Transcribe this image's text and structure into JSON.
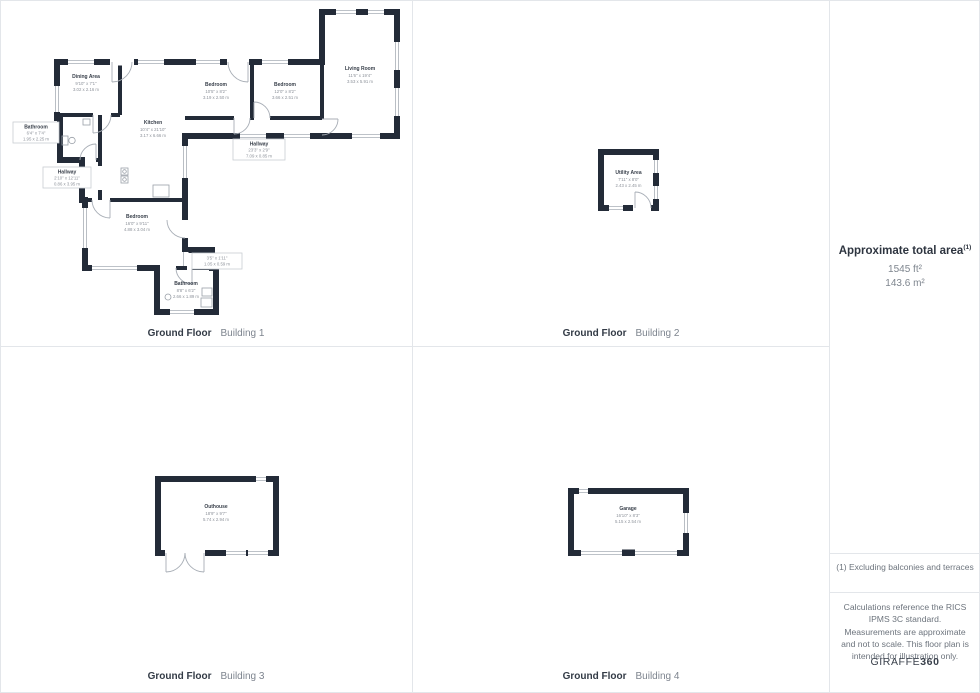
{
  "panels": [
    {
      "caption_bold": "Ground Floor",
      "caption_light": "Building 1",
      "rooms": {
        "dining": {
          "name": "Dining Area",
          "imperial": "9'10\" x 7'1\"",
          "metric": "3.02 x 2.16 m"
        },
        "kitchen": {
          "name": "Kitchen",
          "imperial": "10'4\" x 21'10\"",
          "metric": "3.17 x 6.66 m"
        },
        "bedroom1": {
          "name": "Bedroom",
          "imperial": "10'5\" x 8'2\"",
          "metric": "3.19 x 2.50 m"
        },
        "bedroom2": {
          "name": "Bedroom",
          "imperial": "12'0\" x 8'2\"",
          "metric": "3.66 x 2.51 m"
        },
        "living": {
          "name": "Living Room",
          "imperial": "11'6\" x 19'4\"",
          "metric": "3.53 x 5.91 m"
        },
        "hallway_top": {
          "name": "Hallway",
          "imperial": "23'3\" x 2'9\"",
          "metric": "7.09 x 0.85 m"
        },
        "bathroom_left": {
          "name": "Bathroom",
          "imperial": "6'4\" x 7'4\"",
          "metric": "1.95 x 2.25 m"
        },
        "hallway_left": {
          "name": "Hallway",
          "imperial": "2'10\" x 12'11\"",
          "metric": "0.86 x 3.95 m"
        },
        "bedroom3": {
          "name": "Bedroom",
          "imperial": "16'0\" x 9'11\"",
          "metric": "4.88 x 3.04 m"
        },
        "closet": {
          "imperial": "3'5\" x 1'11\"",
          "metric": "1.05 x 0.59 m"
        },
        "bathroom_btm": {
          "name": "Bathroom",
          "imperial": "8'8\" x 6'2\"",
          "metric": "2.66 x 1.89 m"
        }
      }
    },
    {
      "caption_bold": "Ground Floor",
      "caption_light": "Building 2",
      "rooms": {
        "utility": {
          "name": "Utility Area",
          "imperial": "7'11\" x 8'0\"",
          "metric": "2.43 x 2.45 m"
        }
      }
    },
    {
      "caption_bold": "Ground Floor",
      "caption_light": "Building 3",
      "rooms": {
        "outhouse": {
          "name": "Outhouse",
          "imperial": "18'9\" x 9'7\"",
          "metric": "5.74 x 2.94 m"
        }
      }
    },
    {
      "caption_bold": "Ground Floor",
      "caption_light": "Building 4",
      "rooms": {
        "garage": {
          "name": "Garage",
          "imperial": "16'10\" x 8'3\"",
          "metric": "5.15 x 2.54 m"
        }
      }
    }
  ],
  "sidebar": {
    "title": "Approximate total area",
    "title_sup": "(1)",
    "area_ft": "1545 ft²",
    "area_m": "143.6 m²",
    "note": "(1) Excluding balconies and terraces",
    "disclaimer": "Calculations reference the RICS IPMS 3C standard. Measurements are approximate and not to scale. This floor plan is intended for illustration only.",
    "brand_regular": "GIRAFFE",
    "brand_bold": "360"
  },
  "colors": {
    "wall": "#232b38",
    "room_name_text": "#39404b",
    "dimension_text": "#8d929a",
    "divider": "#e3e6ea"
  }
}
